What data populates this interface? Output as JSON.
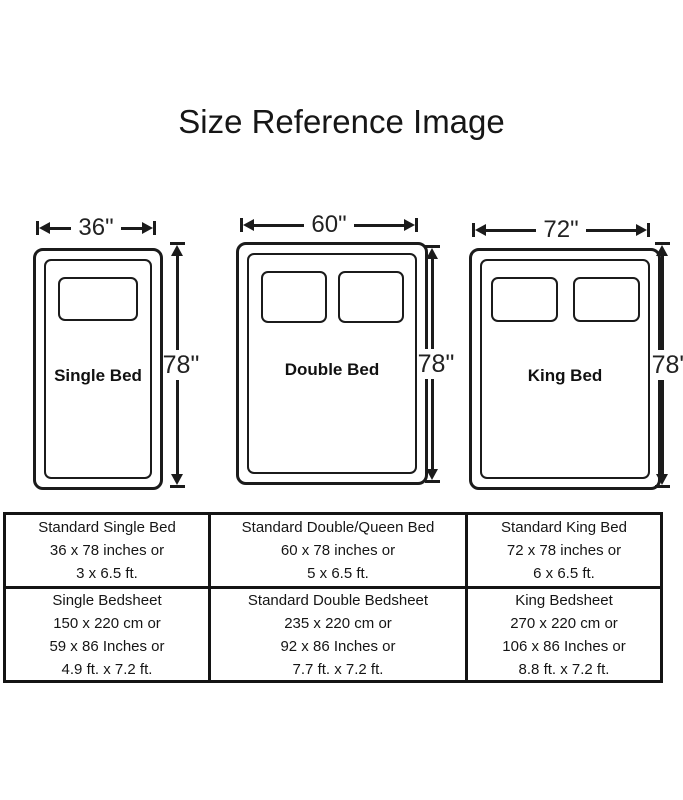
{
  "title": "Size Reference Image",
  "colors": {
    "ink": "#1b1b1b",
    "background": "#ffffff"
  },
  "beds": [
    {
      "name": "Single Bed",
      "width_label": "36\"",
      "height_label": "78\"",
      "pillows": 1
    },
    {
      "name": "Double Bed",
      "width_label": "60\"",
      "height_label": "78\"",
      "pillows": 2
    },
    {
      "name": "King Bed",
      "width_label": "72\"",
      "height_label": "78\"",
      "pillows": 2
    }
  ],
  "table": {
    "rows": [
      [
        {
          "lines": [
            "Standard Single Bed",
            "36 x 78 inches or",
            "3 x 6.5 ft."
          ]
        },
        {
          "lines": [
            "Standard Double/Queen Bed",
            "60 x 78 inches or",
            "5 x 6.5 ft."
          ]
        },
        {
          "lines": [
            "Standard King Bed",
            "72 x 78 inches or",
            "6 x 6.5 ft."
          ]
        }
      ],
      [
        {
          "lines": [
            "Single Bedsheet",
            "150 x 220 cm or",
            "59 x 86 Inches or",
            "4.9 ft. x 7.2 ft."
          ]
        },
        {
          "lines": [
            "Standard Double Bedsheet",
            "235 x 220 cm or",
            "92 x 86 Inches or",
            "7.7 ft. x 7.2 ft."
          ]
        },
        {
          "lines": [
            "King Bedsheet",
            "270 x 220 cm or",
            "106 x 86 Inches or",
            "8.8 ft. x 7.2 ft."
          ]
        }
      ]
    ]
  }
}
